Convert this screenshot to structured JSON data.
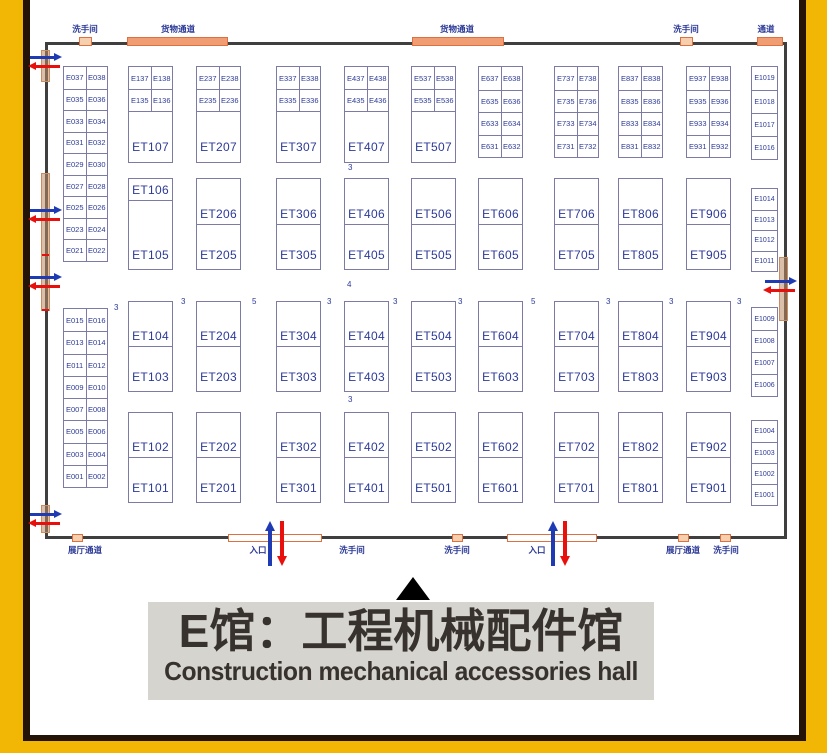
{
  "title": {
    "cn": "E馆：工程机械配件馆",
    "en": "Construction mechanical accessories hall"
  },
  "colors": {
    "booth_border": "#7b7ba6",
    "booth_text": "#2c3a96",
    "wall": "#3f3f3f",
    "door_long_fill": "#f09d74",
    "door_small_fill": "#f6cfae",
    "door_stroke": "#dd7040",
    "entry_arrow_in": "#1f3bb3",
    "entry_arrow_out": "#e8100c",
    "frame_yellow": "#f2b705",
    "frame_dark": "#241407",
    "title_bg": "#d6d4cf",
    "title_text": "#37322e"
  },
  "icons": {
    "up_triangle": "black up-pointing triangle",
    "blue_arrow": "entry direction arrow",
    "red_arrow": "exit direction arrow"
  },
  "floorplan": {
    "wall_labels_top": [
      {
        "x": 85,
        "t": "洗手间"
      },
      {
        "x": 178,
        "t": "货物通道"
      },
      {
        "x": 457,
        "t": "货物通道"
      },
      {
        "x": 686,
        "t": "洗手间"
      },
      {
        "x": 766,
        "t": "通道"
      }
    ],
    "wall_labels_bottom": [
      {
        "x": 85,
        "t": "展厅通道"
      },
      {
        "x": 258,
        "t": "入口"
      },
      {
        "x": 352,
        "t": "洗手间"
      },
      {
        "x": 457,
        "t": "洗手间"
      },
      {
        "x": 537,
        "t": "入口"
      },
      {
        "x": 683,
        "t": "展厅通道"
      },
      {
        "x": 726,
        "t": "洗手间"
      }
    ],
    "left_pair_columns": [
      {
        "x": 63,
        "y": 66,
        "w": 45,
        "h": 196,
        "rows": [
          [
            "E037",
            "E038"
          ],
          [
            "E035",
            "E036"
          ],
          [
            "E033",
            "E034"
          ],
          [
            "E031",
            "E032"
          ],
          [
            "E029",
            "E030"
          ],
          [
            "E027",
            "E028"
          ],
          [
            "E025",
            "E026"
          ],
          [
            "E023",
            "E024"
          ],
          [
            "E021",
            "E022"
          ]
        ]
      },
      {
        "x": 63,
        "y": 308,
        "w": 45,
        "h": 180,
        "rows": [
          [
            "E015",
            "E016"
          ],
          [
            "E013",
            "E014"
          ],
          [
            "E011",
            "E012"
          ],
          [
            "E009",
            "E010"
          ],
          [
            "E007",
            "E008"
          ],
          [
            "E005",
            "E006"
          ],
          [
            "E003",
            "E004"
          ],
          [
            "E001",
            "E002"
          ]
        ]
      }
    ],
    "top_towers": {
      "y": 66,
      "h": 97,
      "w": 45,
      "pair_h": 22,
      "items": [
        {
          "x": 128,
          "pairs": [
            [
              "E137",
              "E138"
            ],
            [
              "E135",
              "E136"
            ]
          ],
          "label": "ET107"
        },
        {
          "x": 196,
          "pairs": [
            [
              "E237",
              "E238"
            ],
            [
              "E235",
              "E236"
            ]
          ],
          "label": "ET207"
        },
        {
          "x": 276,
          "pairs": [
            [
              "E337",
              "E338"
            ],
            [
              "E335",
              "E336"
            ]
          ],
          "label": "ET307"
        },
        {
          "x": 344,
          "pairs": [
            [
              "E437",
              "E438"
            ],
            [
              "E435",
              "E436"
            ]
          ],
          "label": "ET407"
        },
        {
          "x": 411,
          "pairs": [
            [
              "E537",
              "E538"
            ],
            [
              "E535",
              "E536"
            ]
          ],
          "label": "ET507"
        }
      ]
    },
    "top_quad_columns": {
      "y": 66,
      "h": 92,
      "w": 45,
      "items": [
        {
          "x": 478,
          "rows": [
            [
              "E637",
              "E638"
            ],
            [
              "E635",
              "E636"
            ],
            [
              "E633",
              "E634"
            ],
            [
              "E631",
              "E632"
            ]
          ]
        },
        {
          "x": 554,
          "rows": [
            [
              "E737",
              "E738"
            ],
            [
              "E735",
              "E736"
            ],
            [
              "E733",
              "E734"
            ],
            [
              "E731",
              "E732"
            ]
          ]
        },
        {
          "x": 618,
          "rows": [
            [
              "E837",
              "E838"
            ],
            [
              "E835",
              "E836"
            ],
            [
              "E833",
              "E834"
            ],
            [
              "E831",
              "E832"
            ]
          ]
        },
        {
          "x": 686,
          "rows": [
            [
              "E937",
              "E938"
            ],
            [
              "E935",
              "E936"
            ],
            [
              "E933",
              "E934"
            ],
            [
              "E931",
              "E932"
            ]
          ]
        }
      ]
    },
    "dual_rows": [
      {
        "y": 178,
        "h": 92,
        "w": 45,
        "blocks": [
          {
            "x": 128,
            "top": "ET106",
            "bottom": "ET105",
            "divider": 0.24
          },
          {
            "x": 196,
            "top": "ET206",
            "bottom": "ET205",
            "divider": 0.51
          },
          {
            "x": 276,
            "top": "ET306",
            "bottom": "ET305",
            "divider": 0.51
          },
          {
            "x": 344,
            "top": "ET406",
            "bottom": "ET405",
            "divider": 0.51
          },
          {
            "x": 411,
            "top": "ET506",
            "bottom": "ET505",
            "divider": 0.51
          },
          {
            "x": 478,
            "top": "ET606",
            "bottom": "ET605",
            "divider": 0.51
          },
          {
            "x": 554,
            "top": "ET706",
            "bottom": "ET705",
            "divider": 0.51
          },
          {
            "x": 618,
            "top": "ET806",
            "bottom": "ET805",
            "divider": 0.51
          },
          {
            "x": 686,
            "top": "ET906",
            "bottom": "ET905",
            "divider": 0.51
          }
        ]
      },
      {
        "y": 301,
        "h": 91,
        "w": 45,
        "blocks": [
          {
            "x": 128,
            "top": "ET104",
            "bottom": "ET103",
            "divider": 0.5
          },
          {
            "x": 196,
            "top": "ET204",
            "bottom": "ET203",
            "divider": 0.5
          },
          {
            "x": 276,
            "top": "ET304",
            "bottom": "ET303",
            "divider": 0.5
          },
          {
            "x": 344,
            "top": "ET404",
            "bottom": "ET403",
            "divider": 0.5
          },
          {
            "x": 411,
            "top": "ET504",
            "bottom": "ET503",
            "divider": 0.5
          },
          {
            "x": 478,
            "top": "ET604",
            "bottom": "ET603",
            "divider": 0.5
          },
          {
            "x": 554,
            "top": "ET704",
            "bottom": "ET703",
            "divider": 0.5
          },
          {
            "x": 618,
            "top": "ET804",
            "bottom": "ET803",
            "divider": 0.5
          },
          {
            "x": 686,
            "top": "ET904",
            "bottom": "ET903",
            "divider": 0.5
          }
        ]
      },
      {
        "y": 412,
        "h": 91,
        "w": 45,
        "blocks": [
          {
            "x": 128,
            "top": "ET102",
            "bottom": "ET101",
            "divider": 0.5
          },
          {
            "x": 196,
            "top": "ET202",
            "bottom": "ET201",
            "divider": 0.5
          },
          {
            "x": 276,
            "top": "ET302",
            "bottom": "ET301",
            "divider": 0.5
          },
          {
            "x": 344,
            "top": "ET402",
            "bottom": "ET401",
            "divider": 0.5
          },
          {
            "x": 411,
            "top": "ET502",
            "bottom": "ET501",
            "divider": 0.5
          },
          {
            "x": 478,
            "top": "ET602",
            "bottom": "ET601",
            "divider": 0.5
          },
          {
            "x": 554,
            "top": "ET702",
            "bottom": "ET701",
            "divider": 0.5
          },
          {
            "x": 618,
            "top": "ET802",
            "bottom": "ET801",
            "divider": 0.5
          },
          {
            "x": 686,
            "top": "ET902",
            "bottom": "ET901",
            "divider": 0.5
          }
        ]
      }
    ],
    "side_groups": {
      "x": 751,
      "w": 27,
      "groups": [
        {
          "y": 66,
          "h": 94,
          "cells": [
            "E1019",
            "E1018",
            "E1017",
            "E1016"
          ]
        },
        {
          "y": 188,
          "h": 84,
          "cells": [
            "E1014",
            "E1013",
            "E1012",
            "E1011"
          ]
        },
        {
          "y": 307,
          "h": 90,
          "cells": [
            "E1009",
            "E1008",
            "E1007",
            "E1006"
          ]
        },
        {
          "y": 420,
          "h": 86,
          "cells": [
            "E1004",
            "E1003",
            "E1002",
            "E1001"
          ]
        }
      ]
    },
    "aisle_numbers": [
      {
        "x": 348,
        "y": 163,
        "v": "3"
      },
      {
        "x": 347,
        "y": 280,
        "v": "4"
      },
      {
        "x": 348,
        "y": 395,
        "v": "3"
      },
      {
        "x": 114,
        "y": 303,
        "v": "3"
      },
      {
        "x": 181,
        "y": 297,
        "v": "3"
      },
      {
        "x": 252,
        "y": 297,
        "v": "5"
      },
      {
        "x": 327,
        "y": 297,
        "v": "3"
      },
      {
        "x": 393,
        "y": 297,
        "v": "3"
      },
      {
        "x": 458,
        "y": 297,
        "v": "3"
      },
      {
        "x": 531,
        "y": 297,
        "v": "5"
      },
      {
        "x": 606,
        "y": 297,
        "v": "3"
      },
      {
        "x": 669,
        "y": 297,
        "v": "3"
      },
      {
        "x": 737,
        "y": 297,
        "v": "3"
      }
    ],
    "doors_top": [
      {
        "x": 79,
        "w": 13,
        "kind": "small"
      },
      {
        "x": 127,
        "w": 101,
        "kind": "long"
      },
      {
        "x": 412,
        "w": 92,
        "kind": "long"
      },
      {
        "x": 680,
        "w": 13,
        "kind": "small"
      },
      {
        "x": 757,
        "w": 26,
        "kind": "long"
      }
    ],
    "doors_bottom": [
      {
        "x": 72,
        "w": 11,
        "kind": "small"
      },
      {
        "x": 228,
        "w": 94,
        "kind": "entry"
      },
      {
        "x": 452,
        "w": 11,
        "kind": "small"
      },
      {
        "x": 507,
        "w": 90,
        "kind": "entry"
      },
      {
        "x": 678,
        "w": 11,
        "kind": "small"
      },
      {
        "x": 720,
        "w": 11,
        "kind": "small"
      }
    ],
    "wall_strips_left": [
      {
        "y": 50,
        "h": 32
      },
      {
        "y": 173,
        "h": 138
      },
      {
        "y": 505,
        "h": 28
      }
    ],
    "wall_strip_right": {
      "y": 257,
      "h": 64
    },
    "red_ticks_left": [
      {
        "y": 254
      },
      {
        "y": 309
      }
    ],
    "h_arrow_pairs": [
      {
        "x": 28,
        "y": 53
      },
      {
        "x": 28,
        "y": 206
      },
      {
        "x": 28,
        "y": 273
      },
      {
        "x": 28,
        "y": 510
      },
      {
        "x": 763,
        "y": 277
      }
    ],
    "v_arrow_pairs": [
      {
        "x": 265,
        "y": 521
      },
      {
        "x": 548,
        "y": 521
      }
    ]
  }
}
